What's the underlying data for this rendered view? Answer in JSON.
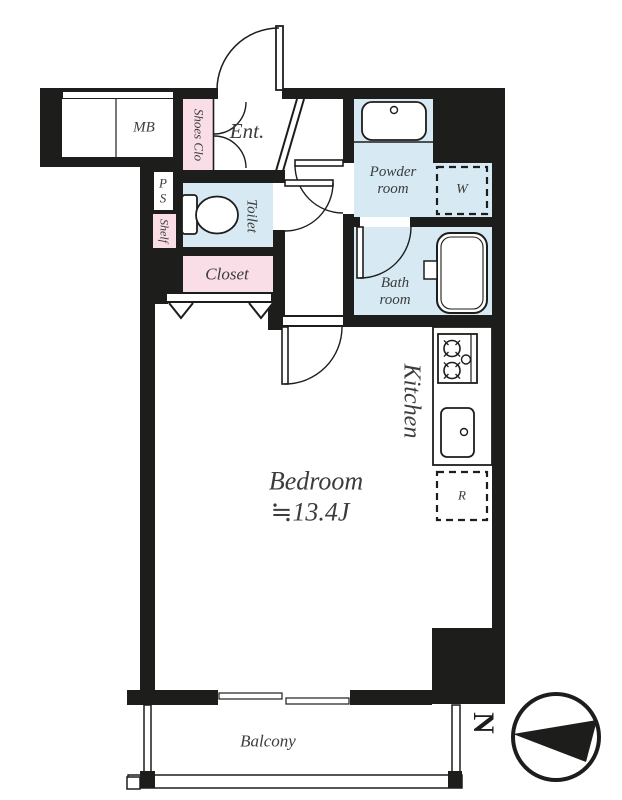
{
  "floorplan": {
    "labels": {
      "mb": "MB",
      "shoes_closet": "Shoes Clo",
      "entrance": "Ent.",
      "pipe_space": "P\nS",
      "shelf": "Shelf",
      "toilet": "Toilet",
      "closet": "Closet",
      "powder_room": "Powder\nroom",
      "washer": "W",
      "bath_room": "Bath\nroom",
      "kitchen": "Kitchen",
      "refrigerator": "R",
      "bedroom": "Bedroom",
      "bedroom_size": "≒13.4J",
      "balcony": "Balcony",
      "north": "N"
    },
    "colors": {
      "wall": "#1d1d1b",
      "room_pink": "#f9dee8",
      "room_blue": "#d7eaf4",
      "text": "#3c3c3c"
    }
  }
}
